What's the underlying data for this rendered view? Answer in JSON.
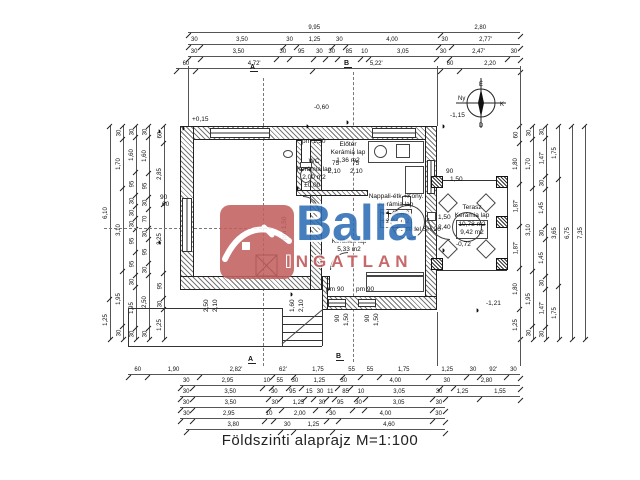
{
  "title": "Földszinti alaprajz M=1:100",
  "watermark": {
    "brand": "Balla",
    "sub": "INGATLAN"
  },
  "compass": {
    "n": "É",
    "e": "K",
    "s": "D",
    "w": "Ny"
  },
  "sections": {
    "a": "A",
    "b": "B"
  },
  "icons": {
    "benchmark": "◑"
  },
  "rooms": {
    "wc": {
      "name": "WC",
      "material": "Kerámia lap",
      "area": "2,00 m2"
    },
    "eloter": {
      "name": "Előtér",
      "material": "Kerámia lap",
      "area": "1,36 m2"
    },
    "nappali": {
      "name": "Nappali-étk.+Kony.",
      "material": "Kerámia lap",
      "area_old": "24,49 m2",
      "area": "22,44 m2"
    },
    "kozlekedo": {
      "material": "Kerámia lap",
      "area": "5,33 m2"
    },
    "terasz": {
      "name": "Terasz",
      "material": "Kerámia lap",
      "area_old": "10,78 m2",
      "area": "9,42 m2"
    }
  },
  "chimney_label": "Schiedel SH 20",
  "levels": {
    "a": "+0,15",
    "b": "-0,60",
    "c": "-1,15",
    "d": "±0,00",
    "e": "-0,72",
    "f": "-1,21"
  },
  "inline_dims": [
    "pm 1,50",
    "pm 1,50",
    "2,50",
    "2,10",
    "1,60",
    "2,10",
    "pm 90",
    "pm 90",
    "90",
    "1,50",
    "90",
    "1,50",
    "75",
    "75",
    "2,10",
    "2,10",
    "90",
    "60",
    "90",
    "1,50",
    "1,50",
    "2,40"
  ],
  "chains": {
    "top": [
      [
        "9,95",
        "2,80"
      ],
      [
        "30",
        "3,50",
        "30",
        "1,25",
        "30",
        "4,00",
        "30",
        "2,77'"
      ],
      [
        "30",
        "3,50",
        "30",
        "95",
        "30",
        "30",
        "85",
        "10",
        "3,05",
        "30",
        "2,47'",
        "30"
      ],
      [
        "60",
        "4,72'",
        "5,22'",
        "60",
        "2,20"
      ]
    ],
    "left": [
      [
        "6,10",
        "1,25"
      ],
      [
        "30",
        "1,70",
        "3,10",
        "1,95",
        "30"
      ],
      [
        "30",
        "1,60",
        "95",
        "30",
        "30",
        "30",
        "95",
        "95",
        "30",
        "1,95",
        "30"
      ],
      [
        "30",
        "1,60",
        "95",
        "30",
        "70",
        "30",
        "95",
        "30",
        "2,50",
        "30"
      ],
      [
        "60",
        "2,85",
        "3,25",
        "95",
        "30",
        "1,25"
      ]
    ],
    "right": [
      [
        "60",
        "1,80",
        "1,87'",
        "1,87'",
        "1,80",
        "1,25"
      ],
      [
        "30",
        "1,70",
        "3,10",
        "1,95",
        "30"
      ],
      [
        "30",
        "1,47'",
        "30",
        "1,45",
        "30",
        "1,45",
        "30",
        "1,47'",
        "30"
      ],
      [
        "1,75",
        "3,65",
        "1,75"
      ],
      [
        "6,75"
      ],
      [
        "7,35"
      ]
    ],
    "bottom": [
      [
        "60",
        "1,90",
        "2,82'",
        "62'",
        "1,75",
        "55",
        "55",
        "1,75",
        "1,25",
        "30",
        "92'",
        "30"
      ],
      [
        "30",
        "2,95",
        "10",
        "55",
        "30",
        "1,25",
        "30",
        "4,00",
        "30",
        "2,80"
      ],
      [
        "30",
        "3,50",
        "30",
        "95",
        "15",
        "30",
        "11",
        "85",
        "10",
        "3,05",
        "30",
        "1,25",
        "1,55"
      ],
      [
        "30",
        "3,50",
        "30",
        "1,25",
        "30",
        "95",
        "30",
        "3,05",
        "30"
      ],
      [
        "30",
        "2,95",
        "10",
        "2,00",
        "30",
        "4,00",
        "30"
      ],
      [
        "3,80",
        "30",
        "1,25",
        "4,60"
      ]
    ]
  }
}
